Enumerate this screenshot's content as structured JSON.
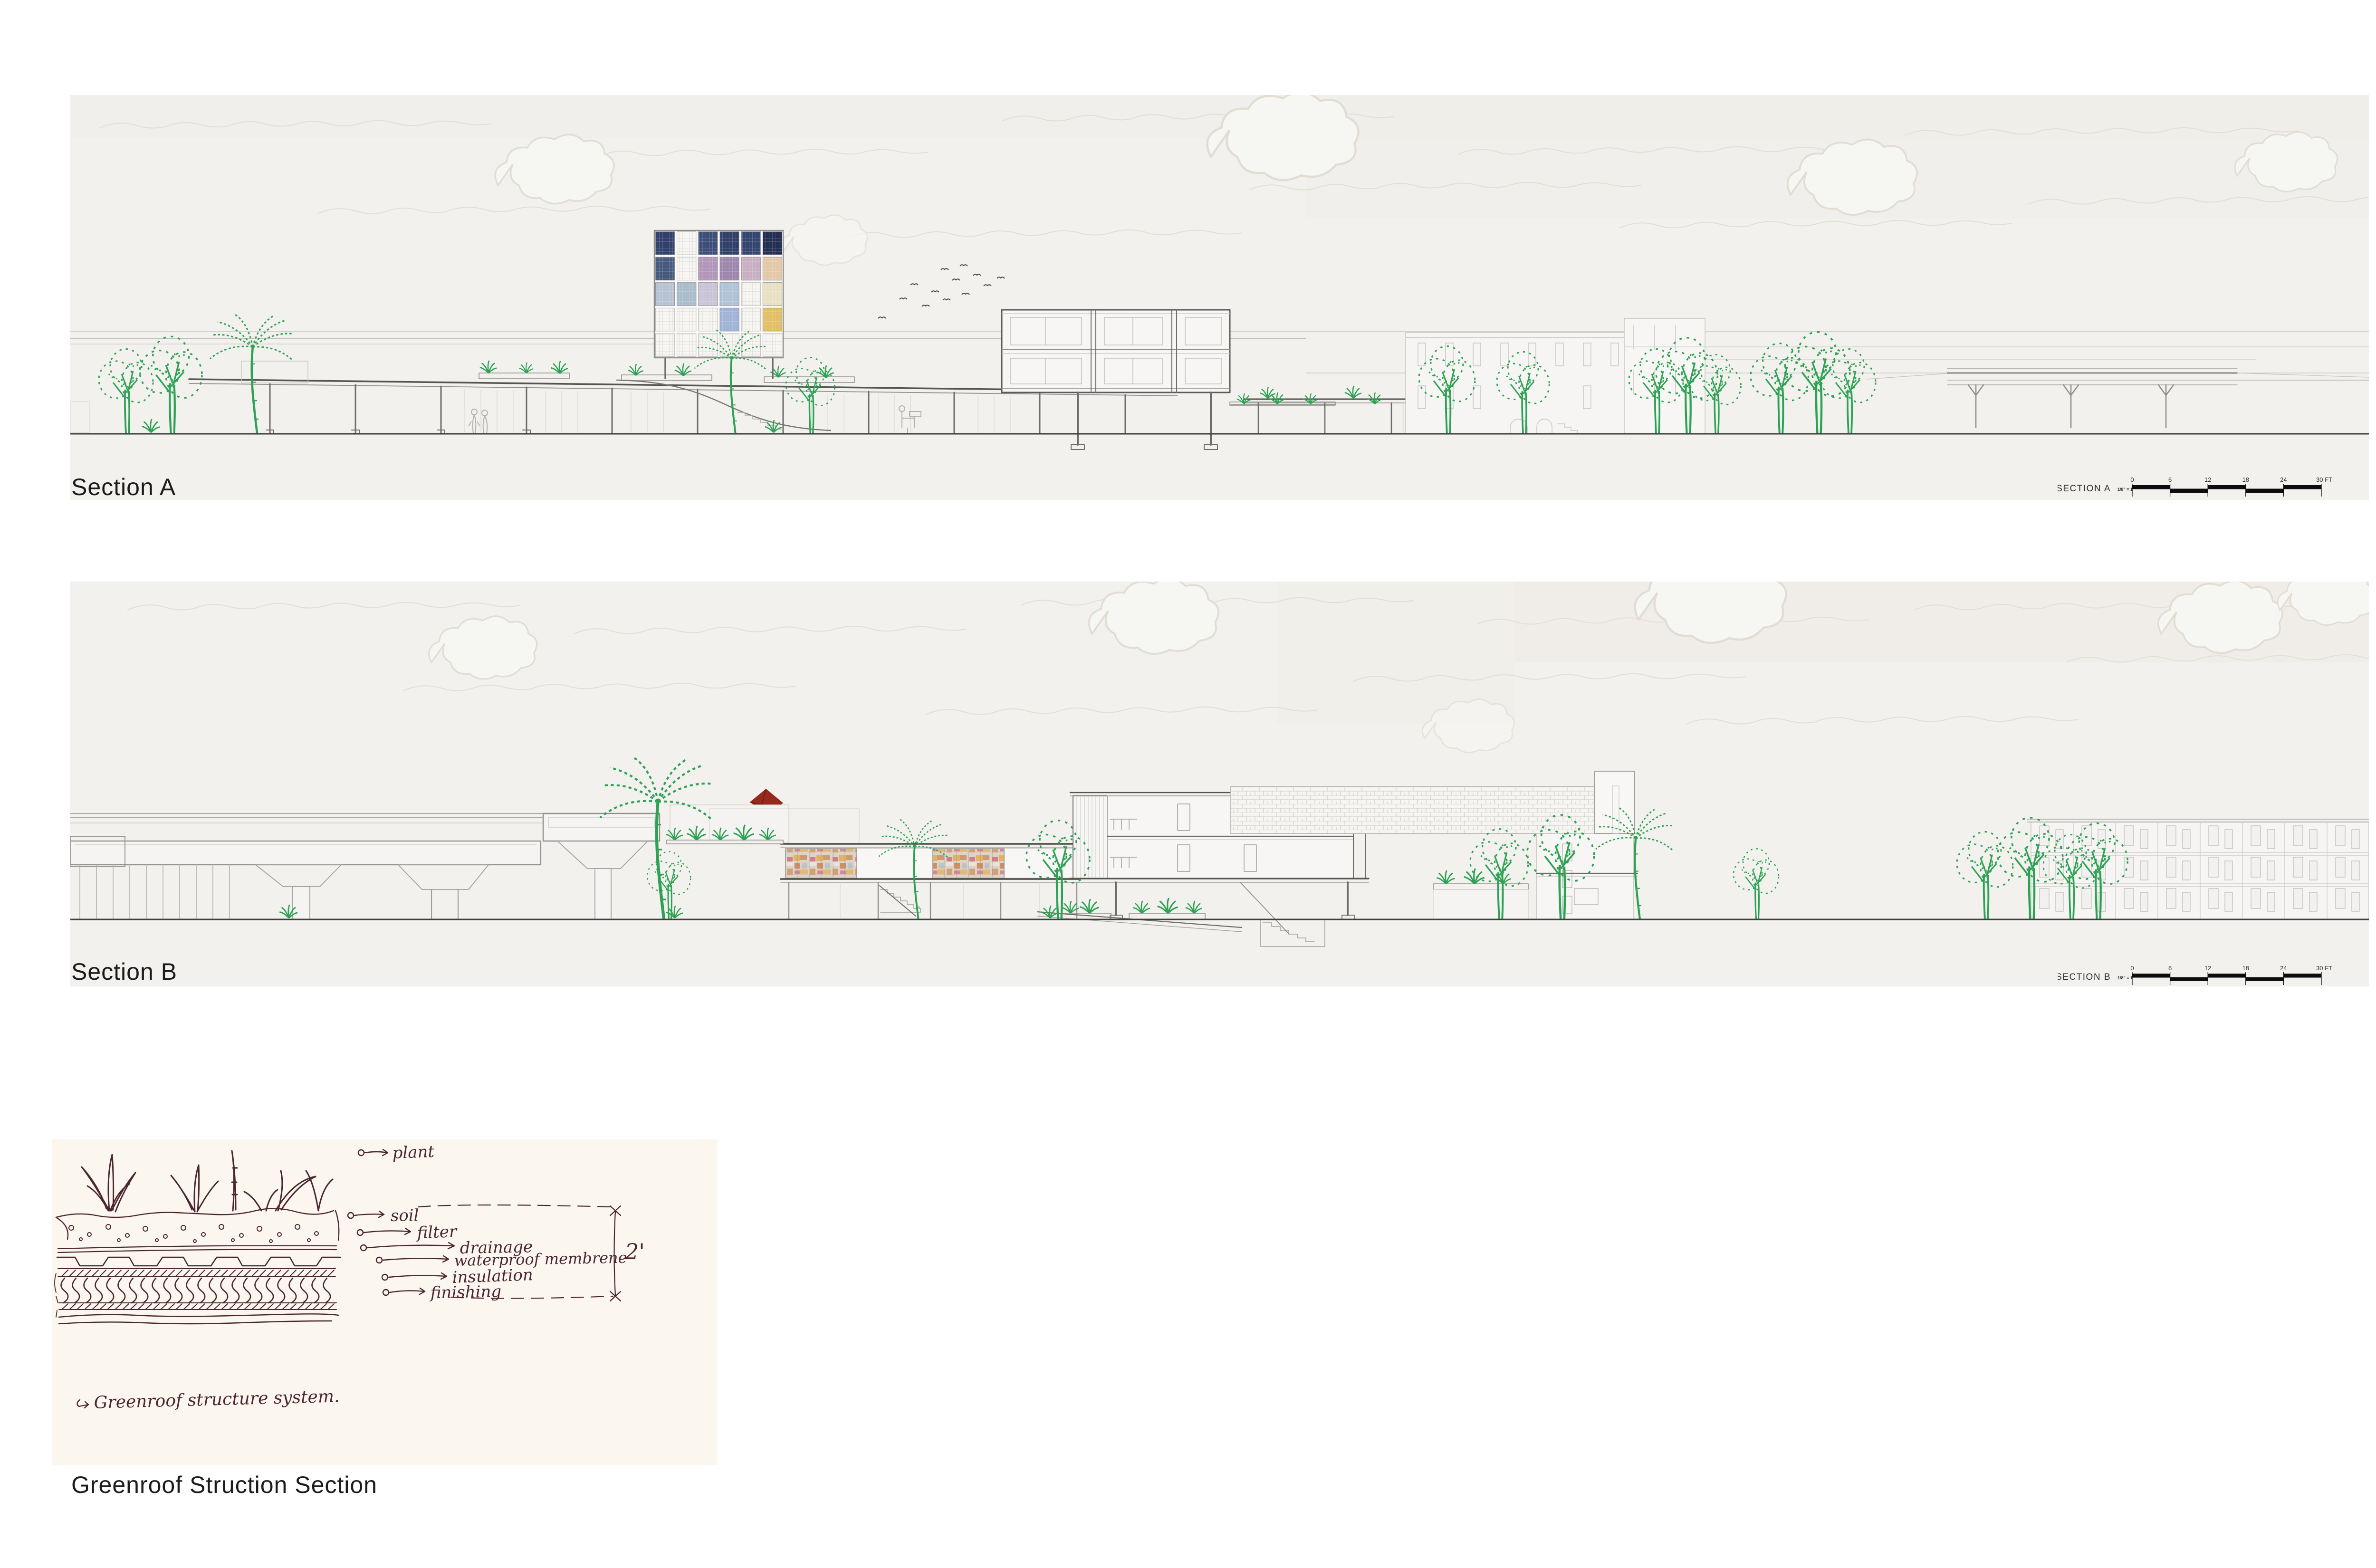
{
  "panels": {
    "section_a": {
      "label": "Section A",
      "scalebar": {
        "title": "SECTION A",
        "ratio": "1/8\" = 1'",
        "ticks": [
          "0",
          "6",
          "12",
          "18",
          "24",
          "30 FT"
        ]
      }
    },
    "section_b": {
      "label": "Section B",
      "scalebar": {
        "title": "SECTION B",
        "ratio": "1/8\" = 1'",
        "ticks": [
          "0",
          "6",
          "12",
          "18",
          "24",
          "30 FT"
        ]
      }
    },
    "greenroof": {
      "label": "Greenroof Struction Section",
      "note": "Greenroof structure system.",
      "dimension": "2'",
      "annotations": [
        "plant",
        "soil",
        "filter",
        "drainage",
        "waterproof membrene",
        "insulation",
        "finishing"
      ]
    }
  },
  "icons": {
    "kite-icon": "diamond kite with curly tail",
    "bird-icon": "v-stroke flying bird"
  },
  "colors": {
    "page_bg": "#ffffff",
    "panel_bg": "#f2f1ee",
    "paper_bg": "#fbf7ee",
    "cloud": "#d8d0c2",
    "line_light": "#c9c7c3",
    "line_mid": "#a1a09d",
    "line_dark": "#6e6d6b",
    "ground": "#3f3f3d",
    "vegetation_green": "#2ea254",
    "ink": "#4b2530",
    "kite_red": "#96291b",
    "scalebar_black": "#0c0c0c",
    "label_text": "#1b1b1b"
  },
  "tower": {
    "rows": 5,
    "cols": 6,
    "cells": [
      [
        "#31406b",
        "mesh",
        "#3c4d78",
        "#2f3f68",
        "#33446f",
        "#232f52"
      ],
      [
        "#45597f",
        "mesh",
        "#b195b8",
        "#9d86ae",
        "#c9aec2",
        "#e3c8a8"
      ],
      [
        "#b7c3d2",
        "#a9bccb",
        "#c9c3d6",
        "#afc2d8",
        "mesh",
        "#e7e0c2"
      ],
      [
        "mesh",
        "mesh",
        "mesh",
        "#9fb3d8",
        "mesh",
        "#e2bf66"
      ],
      [
        "mesh",
        "mesh",
        "mesh",
        "mesh",
        "mesh",
        "mesh"
      ]
    ]
  },
  "collage_colors": [
    "#cf9060",
    "#d4687e",
    "#e5ad52",
    "#b6c2ca",
    "#e9e3d8",
    "#cd7a4e"
  ]
}
